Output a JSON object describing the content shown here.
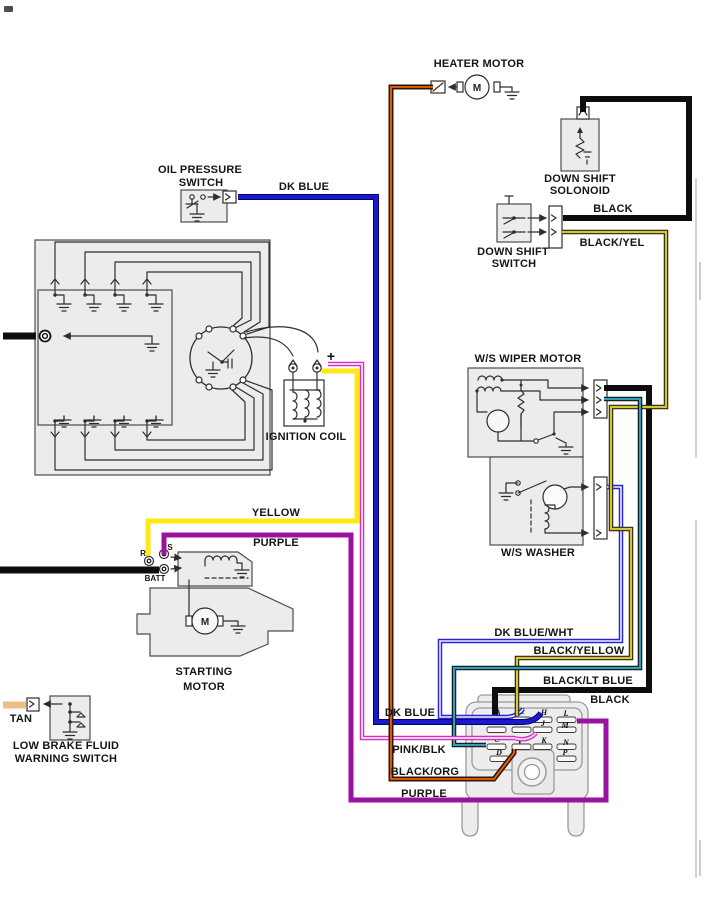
{
  "diagram": {
    "type": "automotive-wiring-diagram",
    "labels": {
      "heater_motor": "HEATER MOTOR",
      "oil_pressure_1": "OIL PRESSURE",
      "oil_pressure_2": "SWITCH",
      "dk_blue_top": "DK BLUE",
      "down_shift_sol_1": "DOWN SHIFT",
      "down_shift_sol_2": "SOLONOID",
      "down_shift_sw_1": "DOWN SHIFT",
      "down_shift_sw_2": "SWITCH",
      "black_top": "BLACK",
      "black_yel": "BLACK/YEL",
      "ws_wiper_motor": "W/S WIPER MOTOR",
      "ws_washer": "W/S WASHER",
      "ignition_coil": "IGNITION COIL",
      "plus": "+",
      "yellow": "YELLOW",
      "purple_mid": "PURPLE",
      "terminal_r": "R",
      "terminal_s": "S",
      "terminal_batt": "BATT",
      "starting_motor_1": "STARTING",
      "starting_motor_2": "MOTOR",
      "motor_m": "M",
      "tan": "TAN",
      "low_brake_1": "LOW BRAKE FLUID",
      "low_brake_2": "WARNING SWITCH",
      "dk_blue_wht": "DK BLUE/WHT",
      "black_yellow": "BLACK/YELLOW",
      "black_lt_blue": "BLACK/LT BLUE",
      "black_bottom": "BLACK",
      "dk_blue_bottom": "DK BLUE",
      "pink_blk": "PINK/BLK",
      "black_org": "BLACK/ORG",
      "purple_bottom": "PURPLE"
    },
    "connector_pins": {
      "a": "A",
      "e": "E",
      "h": "H",
      "l": "L",
      "j": "J",
      "m": "M",
      "c": "C",
      "v": "V",
      "k": "K",
      "n": "N",
      "d": "D",
      "p": "P"
    },
    "wire_colors": {
      "dk_blue": "#1a1acc",
      "dk_blue_wht_edge": "#2a25d4",
      "dk_blue_wht_core": "#eef0ff",
      "yellow": "#ffe913",
      "purple": "#9b11a0",
      "pink_blk_edge": "#d032c2",
      "pink_blk_core": "#f8cdf0",
      "black": "#0d0d0d",
      "black_yel_edge": "#26260e",
      "black_yel_core": "#d6c53a",
      "black_lt_blue_edge": "#101010",
      "black_lt_blue_core": "#2f9fb9",
      "black_org_edge": "#371505",
      "black_org_core": "#e4660c",
      "tan": "#eebf85"
    }
  }
}
